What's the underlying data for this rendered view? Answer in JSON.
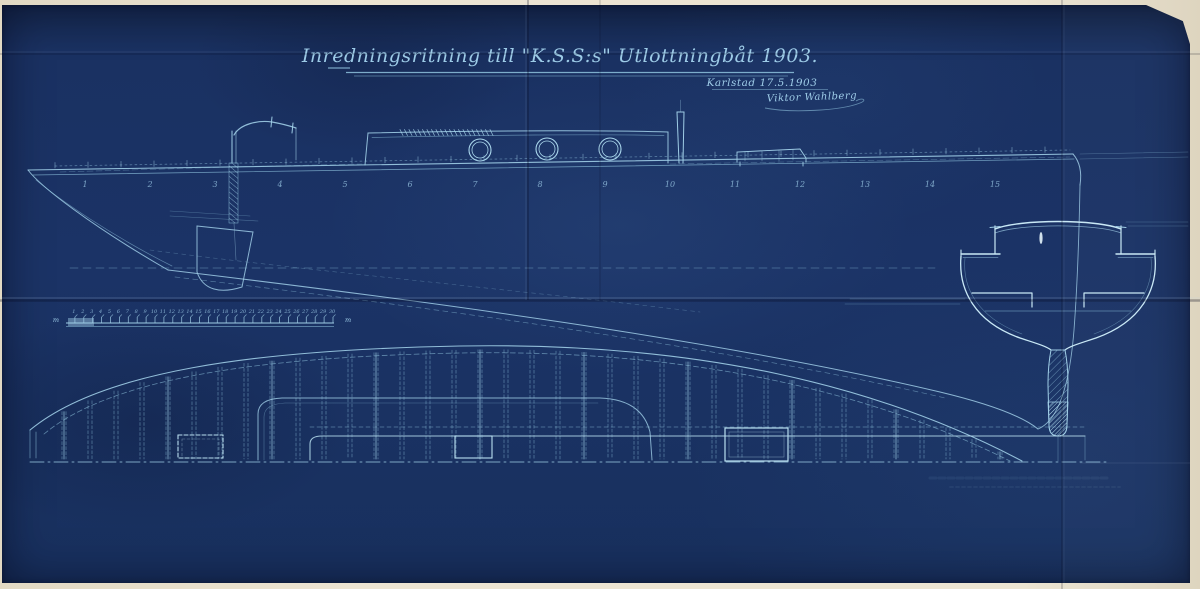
{
  "document": {
    "title": "Inredningsritning till \"K.S.S:s\" Utlottningbåt 1903.",
    "place_date": "Karlstad 17.5.1903",
    "signature": "Viktor Wahlberg"
  },
  "profile": {
    "station_labels": [
      "1",
      "2",
      "3",
      "4",
      "5",
      "6",
      "7",
      "8",
      "9",
      "10",
      "11",
      "12",
      "13",
      "14",
      "15"
    ]
  },
  "scale_bar": {
    "tick_labels": [
      "1",
      "2",
      "3",
      "4",
      "5",
      "6",
      "7",
      "8",
      "9",
      "10",
      "11",
      "12",
      "13",
      "14",
      "15",
      "16",
      "17",
      "18",
      "19",
      "20",
      "21",
      "22",
      "23",
      "24",
      "25",
      "26",
      "27",
      "28",
      "29",
      "30"
    ],
    "unit_left": "m",
    "unit_right": "m"
  },
  "colors": {
    "paper": "#1a3162",
    "line": "#8fc3de",
    "line_bright": "#c9e9f6",
    "text": "#9dcbe7",
    "margin": "#eae2cf"
  }
}
